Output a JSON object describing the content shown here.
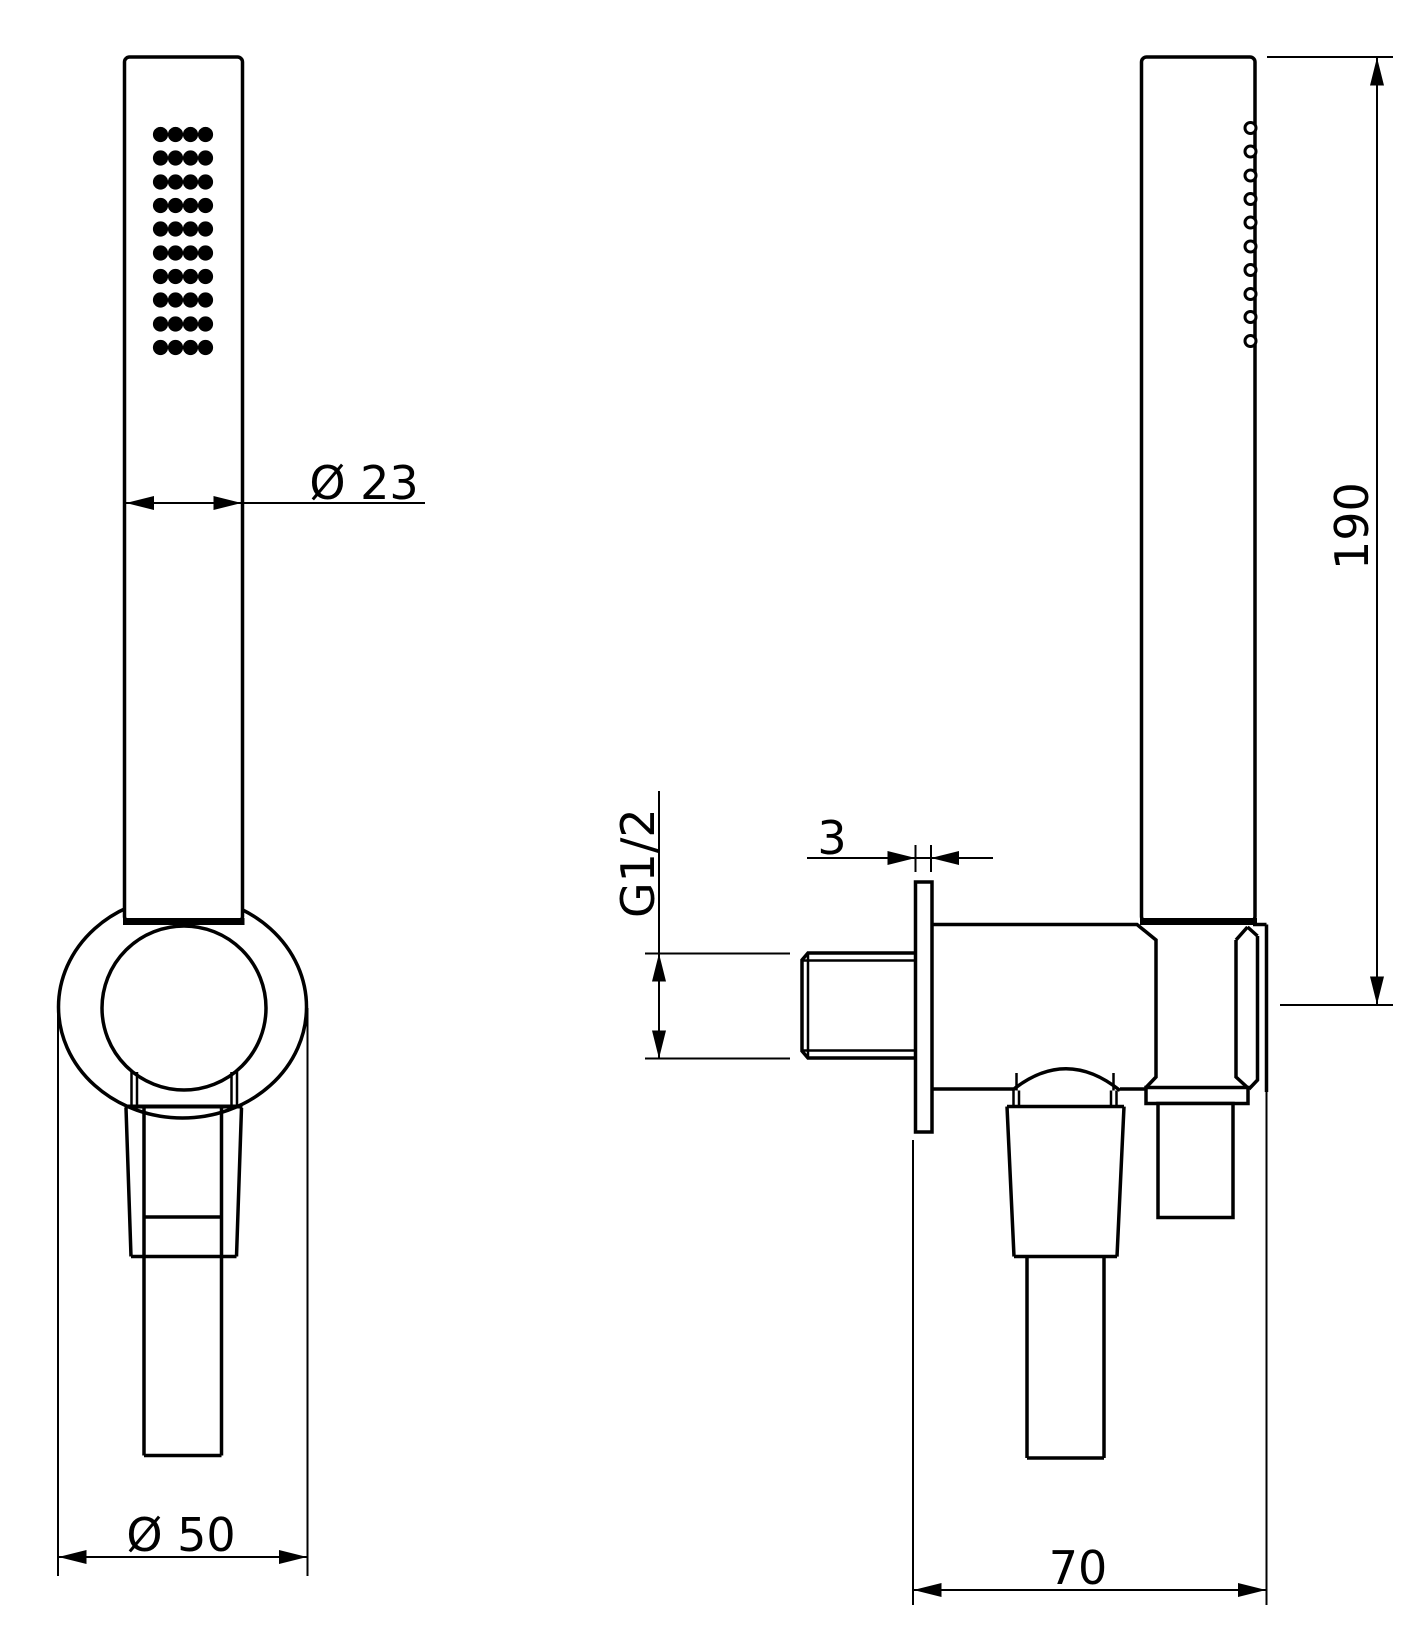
{
  "drawing": {
    "colors": {
      "line": "#000000",
      "background": "#ffffff"
    },
    "dimensions": {
      "head_diameter": "Ø 23",
      "bracket_diameter": "Ø 50",
      "thread_size": "G1/2",
      "wall_plate_thickness": "3",
      "depth": "70",
      "height": "190"
    }
  }
}
